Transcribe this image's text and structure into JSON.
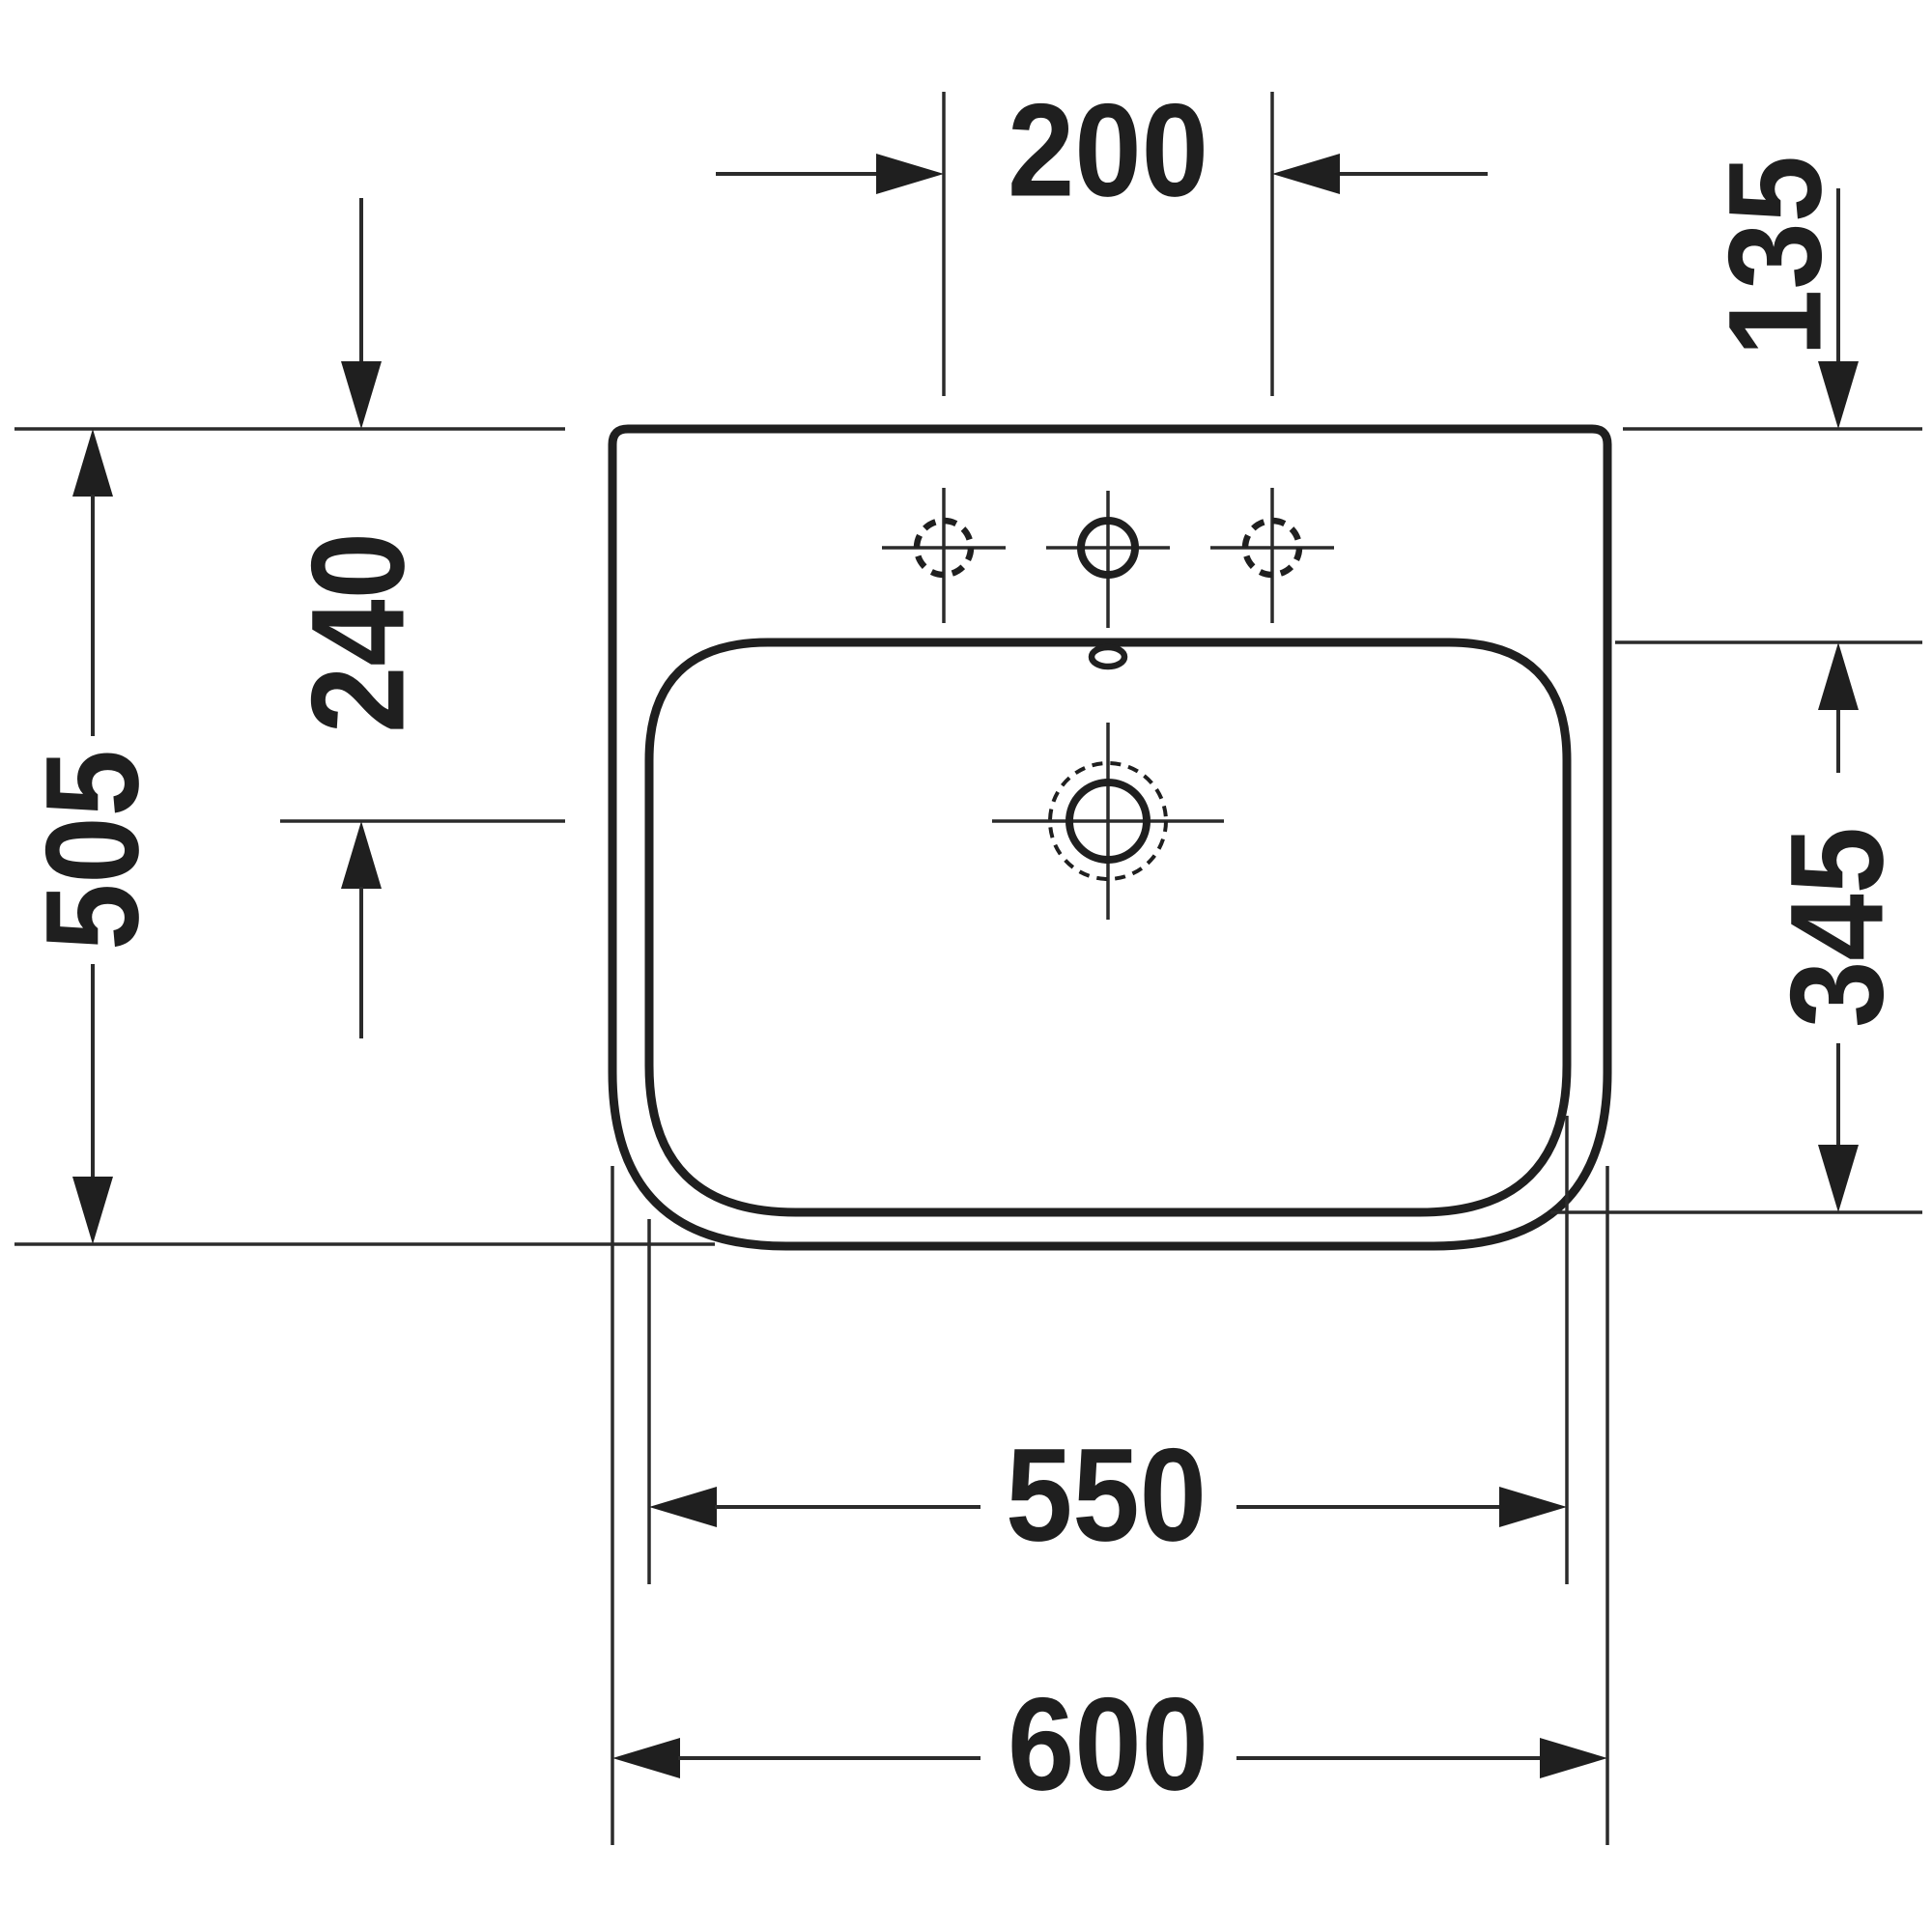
{
  "drawing": {
    "type": "technical dimension drawing",
    "subject": "wall-mounted washbasin, top view",
    "units": "mm",
    "line_color": "#1f1f1f",
    "background_color": "#ffffff"
  },
  "dims": {
    "faucet_hole_spacing": "200",
    "rear_edge_to_basin": "135",
    "rear_edge_to_drain_center": "240",
    "overall_depth": "505",
    "basin_depth": "345",
    "basin_width": "550",
    "overall_width": "600"
  }
}
